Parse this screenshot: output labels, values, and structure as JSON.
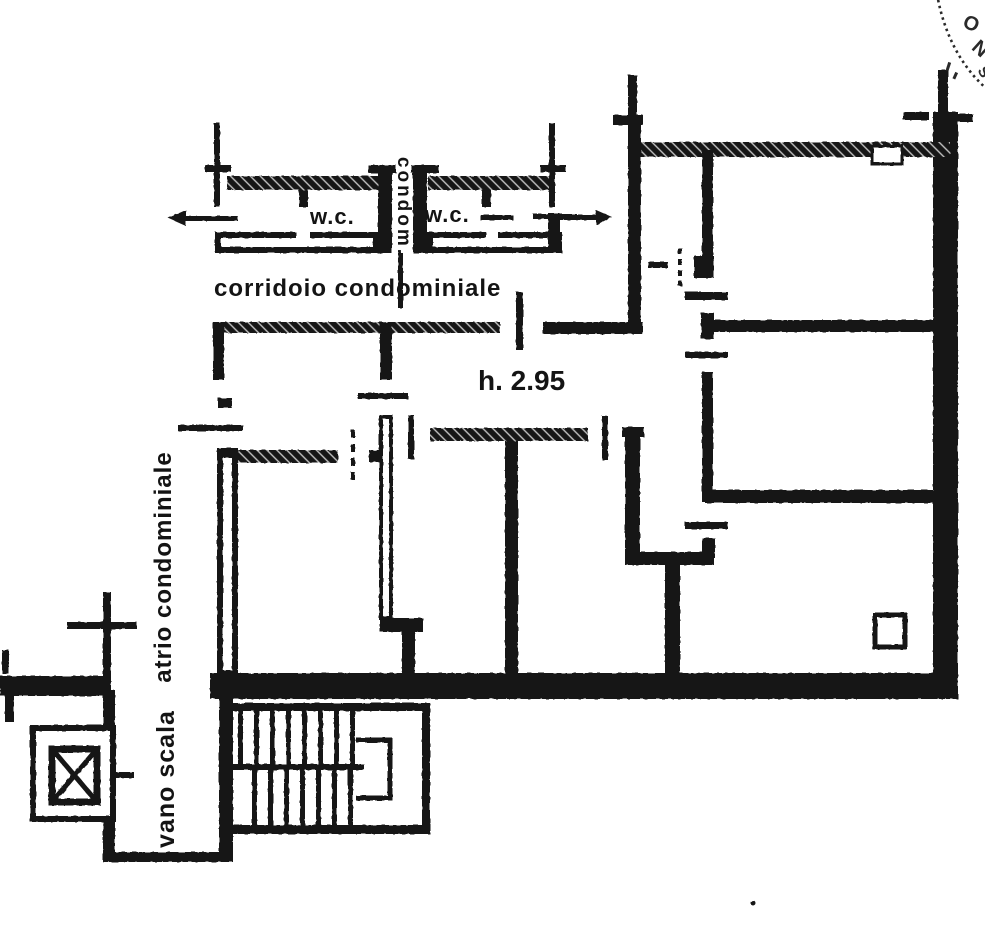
{
  "labels": {
    "wc_left": "w.c.",
    "wc_right": "w.c.",
    "shaft": "condom.",
    "corridor": "corridoio condominiale",
    "ceiling_height": "h. 2.95",
    "atrium": "atrio condominiale",
    "stairwell": "vano scala"
  },
  "stamp": {
    "letters": [
      "O",
      "N",
      "S"
    ]
  },
  "colors": {
    "ink": "#141414",
    "paper": "#ffffff"
  }
}
